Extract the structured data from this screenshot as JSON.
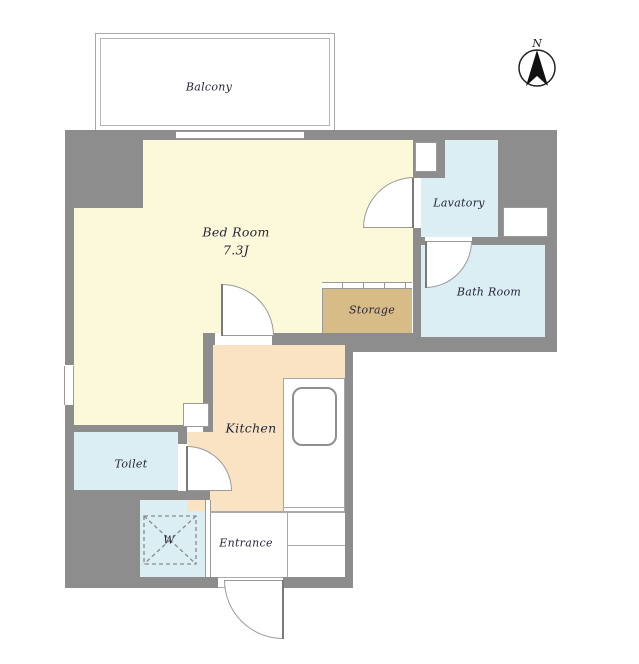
{
  "title": "Apartment floor plan",
  "compass": {
    "north_label": "N"
  },
  "rooms": {
    "balcony": {
      "label": "Balcony"
    },
    "bedroom": {
      "label": "Bed Room",
      "area": "7.3J"
    },
    "lavatory": {
      "label": "Lavatory"
    },
    "bathroom": {
      "label": "Bath Room"
    },
    "storage": {
      "label": "Storage"
    },
    "kitchen": {
      "label": "Kitchen"
    },
    "toilet": {
      "label": "Toilet"
    },
    "washer": {
      "label": "W"
    },
    "entrance": {
      "label": "Entrance"
    }
  },
  "colors": {
    "wall": "#8d8d8d",
    "bedroom": "#fcf9da",
    "kitchen": "#fae3c3",
    "storage": "#d8bc88",
    "wet_rooms": "#daeef3",
    "text": "#26263a"
  }
}
